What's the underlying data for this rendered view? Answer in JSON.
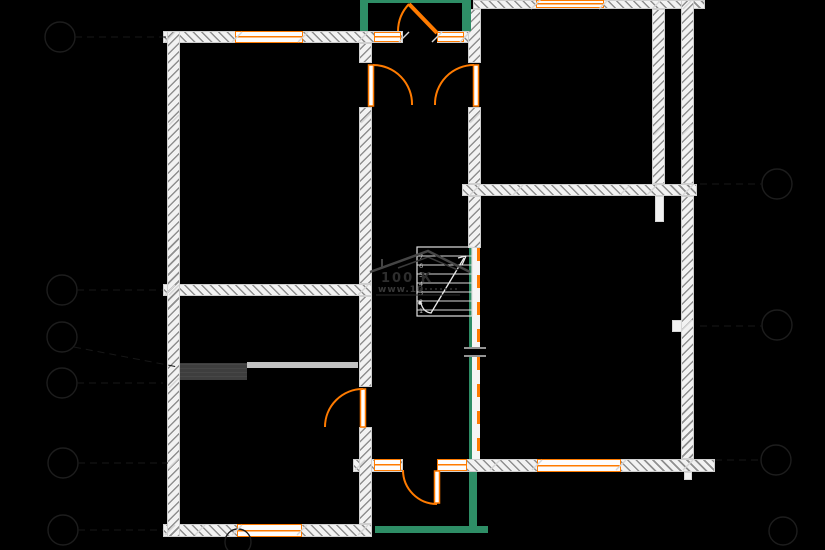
{
  "app": {
    "background": "#000000"
  },
  "watermark": {
    "logo_text": "100 К",
    "url_text": "www.10"
  },
  "stair": {
    "step_labels": [
      "7",
      "6",
      "5",
      "4",
      "3",
      "2",
      "1"
    ]
  },
  "colors": {
    "wall_fill": "#f2f2f2",
    "wall_hatch": "#8f8f8f",
    "window_accent": "#ff7b00",
    "door_accent": "#ff7b00",
    "terrace_green": "#2e8e66",
    "frame_partition_green": "#2e8e66",
    "furniture_dark": "#3e3e3e",
    "furniture_light": "#c2c2c2",
    "stair_line": "#dedede",
    "dimension_tick": "#d6d6d6",
    "axis_line": "#1d1d1d",
    "watermark_gray": "#454545"
  }
}
